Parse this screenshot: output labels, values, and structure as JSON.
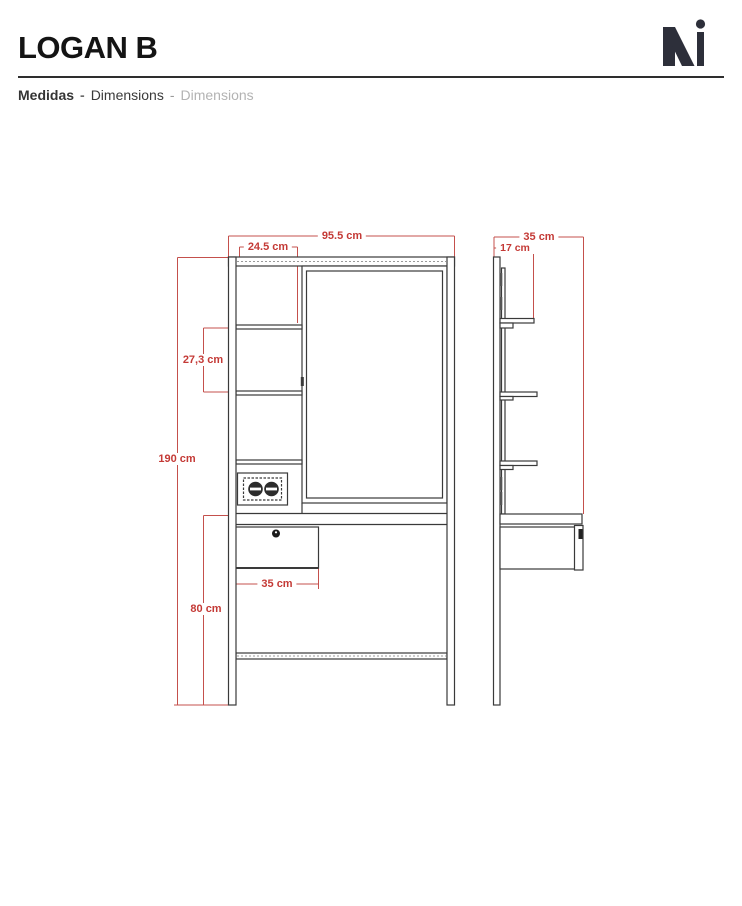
{
  "header": {
    "title": "LOGAN B",
    "logo": {
      "icon": "mi-logo"
    },
    "subtitle": {
      "medidas": "Medidas",
      "sep": "-",
      "dimensions_en": "Dimensions",
      "dimensions_alt": "Dimensions"
    }
  },
  "colors": {
    "dimension_red": "#c43a36",
    "line_dark": "#3a3a3a",
    "logo_dark": "#2d2f3a",
    "subtitle_gray": "#b3b3b3"
  },
  "front_view": {
    "total_width": "95.5 cm",
    "shelf_width": "24.5 cm",
    "shelf_spacing": "27,3 cm",
    "total_height": "190 cm",
    "lower_height": "80 cm",
    "drawer_width": "35 cm"
  },
  "side_view": {
    "total_depth": "35 cm",
    "shelf_depth": "17 cm"
  }
}
